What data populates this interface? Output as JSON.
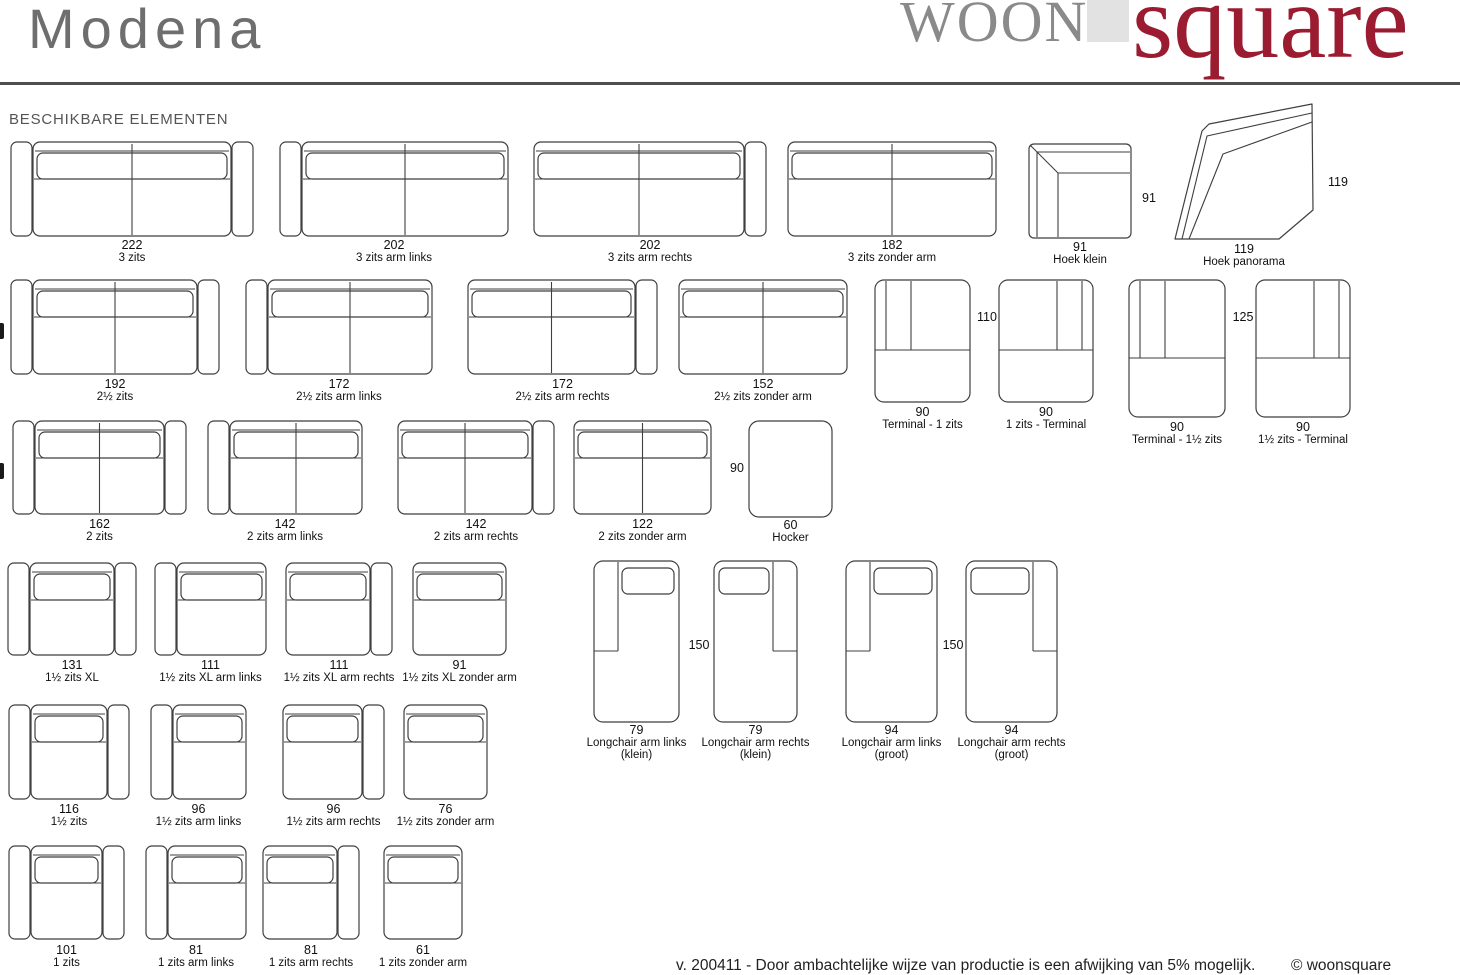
{
  "header": {
    "title": "Modena",
    "logo": {
      "woon": "WOON",
      "square": "square"
    }
  },
  "section_title": "BESCHIKBARE ELEMENTEN",
  "footer": {
    "version_note": "v. 200411 - Door ambachtelijke wijze van productie is een afwijking van 5% mogelijk.",
    "copyright": "© woonsquare"
  },
  "colors": {
    "line": "#3f3f3f",
    "accent_red": "#9b1b30",
    "logo_gray": "#8a8a8a",
    "square_bg": "#e2e2e2",
    "title_gray": "#6e6e6e",
    "rule": "#4f4f4f"
  },
  "edge_marks": [
    {
      "x": 0,
      "y": 323
    },
    {
      "x": 0,
      "y": 463
    }
  ],
  "elements": [
    {
      "kind": "sofa",
      "arms": "both",
      "seats": 2,
      "x": 10,
      "y": 141,
      "w": 244,
      "h": 96,
      "labelY": 239,
      "dim": "222",
      "name": "3 zits"
    },
    {
      "kind": "sofa",
      "arms": "left",
      "seats": 2,
      "x": 279,
      "y": 141,
      "w": 230,
      "h": 96,
      "labelY": 239,
      "dim": "202",
      "name": "3 zits arm links"
    },
    {
      "kind": "sofa",
      "arms": "right",
      "seats": 2,
      "x": 533,
      "y": 141,
      "w": 234,
      "h": 96,
      "labelY": 239,
      "dim": "202",
      "name": "3 zits arm rechts"
    },
    {
      "kind": "sofa",
      "arms": "none",
      "seats": 2,
      "x": 787,
      "y": 141,
      "w": 210,
      "h": 96,
      "labelY": 239,
      "dim": "182",
      "name": "3 zits zonder arm"
    },
    {
      "kind": "hoek-klein",
      "x": 1028,
      "y": 143,
      "w": 104,
      "h": 96,
      "labelY": 241,
      "dim": "91",
      "name": "Hoek klein",
      "sideDims": [
        {
          "text": "91",
          "x": 1149,
          "y": 198
        }
      ]
    },
    {
      "kind": "hoek-panorama",
      "x": 1173,
      "y": 101,
      "w": 142,
      "h": 140,
      "labelY": 243,
      "dim": "119",
      "name": "Hoek panorama",
      "sideDims": [
        {
          "text": "119",
          "x": 1338,
          "y": 182
        }
      ]
    },
    {
      "kind": "sofa",
      "arms": "both",
      "seats": 2,
      "x": 10,
      "y": 279,
      "w": 210,
      "h": 96,
      "labelY": 378,
      "dim": "192",
      "name": "2½ zits"
    },
    {
      "kind": "sofa",
      "arms": "left",
      "seats": 2,
      "x": 245,
      "y": 279,
      "w": 188,
      "h": 96,
      "labelY": 378,
      "dim": "172",
      "name": "2½ zits arm links"
    },
    {
      "kind": "sofa",
      "arms": "right",
      "seats": 2,
      "x": 467,
      "y": 279,
      "w": 191,
      "h": 96,
      "labelY": 378,
      "dim": "172",
      "name": "2½ zits arm rechts"
    },
    {
      "kind": "sofa",
      "arms": "none",
      "seats": 2,
      "x": 678,
      "y": 279,
      "w": 170,
      "h": 96,
      "labelY": 378,
      "dim": "152",
      "name": "2½ zits zonder arm"
    },
    {
      "kind": "terminal",
      "side": "left",
      "x": 874,
      "y": 279,
      "w": 97,
      "h": 124,
      "labelY": 406,
      "dim": "90",
      "name": "Terminal - 1 zits",
      "sideDims": [
        {
          "text": "110",
          "x": 987,
          "y": 317
        }
      ]
    },
    {
      "kind": "terminal",
      "side": "right",
      "x": 998,
      "y": 279,
      "w": 96,
      "h": 124,
      "labelY": 406,
      "dim": "90",
      "name": "1 zits - Terminal"
    },
    {
      "kind": "terminal",
      "side": "left",
      "x": 1128,
      "y": 279,
      "w": 98,
      "h": 139,
      "labelY": 421,
      "dim": "90",
      "name": "Terminal - 1½ zits",
      "sideDims": [
        {
          "text": "125",
          "x": 1243,
          "y": 317
        }
      ]
    },
    {
      "kind": "terminal",
      "side": "right",
      "x": 1255,
      "y": 279,
      "w": 96,
      "h": 139,
      "labelY": 421,
      "dim": "90",
      "name": "1½ zits - Terminal"
    },
    {
      "kind": "sofa",
      "arms": "both",
      "seats": 2,
      "x": 12,
      "y": 420,
      "w": 175,
      "h": 95,
      "labelY": 518,
      "dim": "162",
      "name": "2 zits"
    },
    {
      "kind": "sofa",
      "arms": "left",
      "seats": 2,
      "x": 207,
      "y": 420,
      "w": 156,
      "h": 95,
      "labelY": 518,
      "dim": "142",
      "name": "2 zits arm links"
    },
    {
      "kind": "sofa",
      "arms": "right",
      "seats": 2,
      "x": 397,
      "y": 420,
      "w": 158,
      "h": 95,
      "labelY": 518,
      "dim": "142",
      "name": "2 zits arm rechts"
    },
    {
      "kind": "sofa",
      "arms": "none",
      "seats": 2,
      "x": 573,
      "y": 420,
      "w": 139,
      "h": 95,
      "labelY": 518,
      "dim": "122",
      "name": "2 zits zonder arm"
    },
    {
      "kind": "hocker",
      "x": 748,
      "y": 420,
      "w": 85,
      "h": 98,
      "labelY": 519,
      "dim": "60",
      "name": "Hocker",
      "sideDims": [
        {
          "text": "90",
          "x": 737,
          "y": 468
        }
      ]
    },
    {
      "kind": "sofa",
      "arms": "both",
      "seats": 1,
      "x": 7,
      "y": 562,
      "w": 130,
      "h": 94,
      "labelY": 659,
      "dim": "131",
      "name": "1½ zits XL"
    },
    {
      "kind": "sofa",
      "arms": "left",
      "seats": 1,
      "x": 154,
      "y": 562,
      "w": 113,
      "h": 94,
      "labelY": 659,
      "dim": "111",
      "name": "1½ zits XL arm links"
    },
    {
      "kind": "sofa",
      "arms": "right",
      "seats": 1,
      "x": 285,
      "y": 562,
      "w": 108,
      "h": 94,
      "labelY": 659,
      "dim": "111",
      "name": "1½ zits XL arm rechts"
    },
    {
      "kind": "sofa",
      "arms": "none",
      "seats": 1,
      "x": 412,
      "y": 562,
      "w": 95,
      "h": 94,
      "labelY": 659,
      "dim": "91",
      "name": "1½ zits XL zonder arm"
    },
    {
      "kind": "longchair",
      "side": "left",
      "x": 593,
      "y": 560,
      "w": 87,
      "h": 163,
      "labelY": 724,
      "dim": "79",
      "name": "Longchair arm links",
      "name2": "(klein)",
      "sideDims": [
        {
          "text": "150",
          "x": 699,
          "y": 645
        }
      ]
    },
    {
      "kind": "longchair",
      "side": "right",
      "x": 713,
      "y": 560,
      "w": 85,
      "h": 163,
      "labelY": 724,
      "dim": "79",
      "name": "Longchair arm rechts",
      "name2": "(klein)"
    },
    {
      "kind": "longchair",
      "side": "left",
      "x": 845,
      "y": 560,
      "w": 93,
      "h": 163,
      "labelY": 724,
      "dim": "94",
      "name": "Longchair arm links",
      "name2": "(groot)",
      "sideDims": [
        {
          "text": "150",
          "x": 953,
          "y": 645
        }
      ]
    },
    {
      "kind": "longchair",
      "side": "right",
      "x": 965,
      "y": 560,
      "w": 93,
      "h": 163,
      "labelY": 724,
      "dim": "94",
      "name": "Longchair arm rechts",
      "name2": "(groot)"
    },
    {
      "kind": "sofa",
      "arms": "both",
      "seats": 1,
      "x": 8,
      "y": 704,
      "w": 122,
      "h": 96,
      "labelY": 803,
      "dim": "116",
      "name": "1½ zits"
    },
    {
      "kind": "sofa",
      "arms": "left",
      "seats": 1,
      "x": 150,
      "y": 704,
      "w": 97,
      "h": 96,
      "labelY": 803,
      "dim": "96",
      "name": "1½ zits arm links"
    },
    {
      "kind": "sofa",
      "arms": "right",
      "seats": 1,
      "x": 282,
      "y": 704,
      "w": 103,
      "h": 96,
      "labelY": 803,
      "dim": "96",
      "name": "1½ zits arm rechts"
    },
    {
      "kind": "sofa",
      "arms": "none",
      "seats": 1,
      "x": 403,
      "y": 704,
      "w": 85,
      "h": 96,
      "labelY": 803,
      "dim": "76",
      "name": "1½ zits zonder arm"
    },
    {
      "kind": "sofa",
      "arms": "both",
      "seats": 1,
      "x": 8,
      "y": 845,
      "w": 117,
      "h": 95,
      "labelY": 944,
      "dim": "101",
      "name": "1 zits"
    },
    {
      "kind": "sofa",
      "arms": "left",
      "seats": 1,
      "x": 145,
      "y": 845,
      "w": 102,
      "h": 95,
      "labelY": 944,
      "dim": "81",
      "name": "1 zits arm links"
    },
    {
      "kind": "sofa",
      "arms": "right",
      "seats": 1,
      "x": 262,
      "y": 845,
      "w": 98,
      "h": 95,
      "labelY": 944,
      "dim": "81",
      "name": "1 zits arm rechts"
    },
    {
      "kind": "sofa",
      "arms": "none",
      "seats": 1,
      "x": 383,
      "y": 845,
      "w": 80,
      "h": 95,
      "labelY": 944,
      "dim": "61",
      "name": "1 zits zonder arm"
    }
  ]
}
